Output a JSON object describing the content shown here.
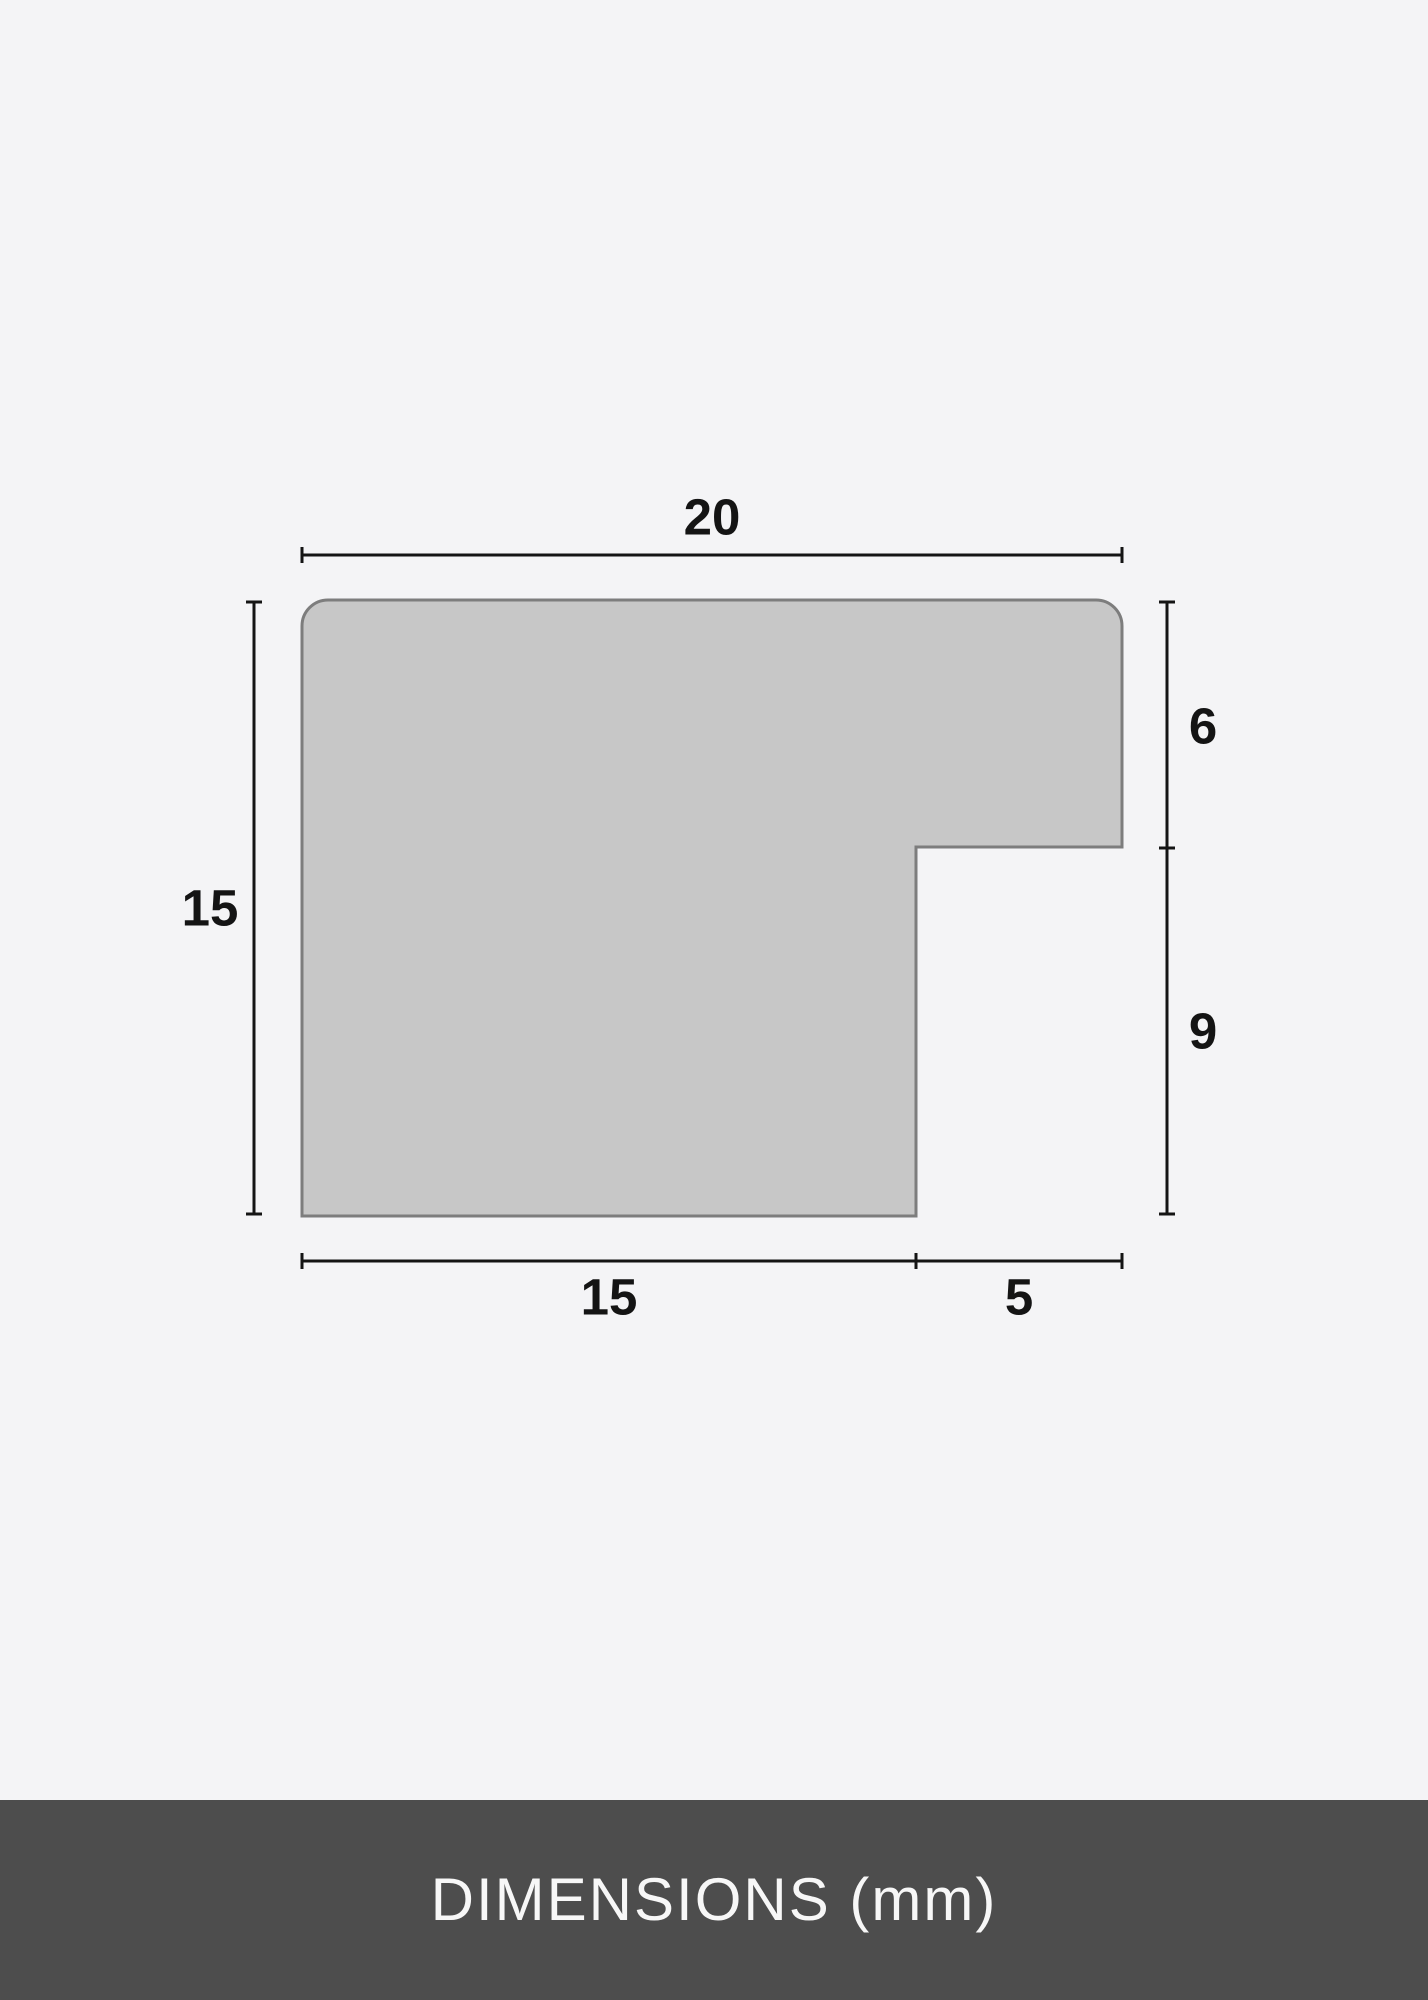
{
  "diagram": {
    "description": "Frame moulding profile cross-section with dimension lines",
    "labels": {
      "top_width": "20",
      "left_height": "15",
      "right_upper_height": "6",
      "right_lower_height": "9",
      "bottom_left_width": "15",
      "bottom_right_width": "5"
    },
    "colors": {
      "background": "#f4f4f6",
      "profile_fill": "#c7c7c7",
      "profile_stroke": "#7d7d7d",
      "dimension_line": "#141414",
      "label_text": "#141414",
      "footer_background": "#4d4d4d",
      "footer_text": "#f7f7f7"
    }
  },
  "footer": {
    "label": "DIMENSIONS (mm)"
  }
}
